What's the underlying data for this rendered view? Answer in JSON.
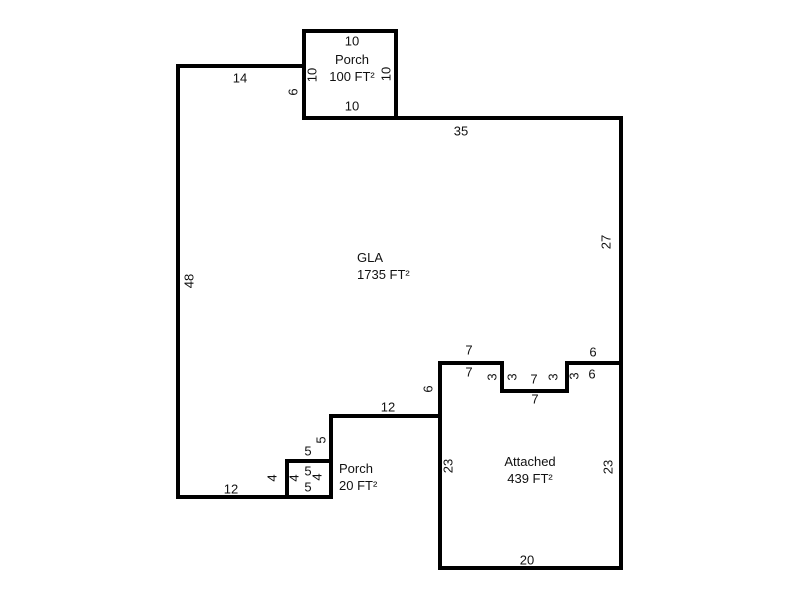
{
  "canvas": {
    "background_color": "#ffffff",
    "wall_color": "#000000",
    "text_color": "#111111"
  },
  "areas": {
    "porch_top": {
      "line1": "Porch",
      "line2": "100 FT²"
    },
    "gla": {
      "line1": "GLA",
      "line2": "1735 FT²"
    },
    "porch_bottom": {
      "line1": "Porch",
      "line2": "20 FT²"
    },
    "attached": {
      "line1": "Attached",
      "line2": "439 FT²"
    }
  },
  "dims": {
    "porch_top_side": "10",
    "porch_left_side": "10",
    "porch_right_side": "10",
    "porch_bottom_side": "10",
    "gla_porch_left_wall": "6",
    "gla_top_left": "14",
    "gla_top_right": "35",
    "gla_right_side": "27",
    "gla_left_side": "48",
    "notch_left_gla": "7",
    "notch_left_att": "7",
    "notch_step1_gla": "3",
    "notch_step1_att": "3",
    "notch_mid_gla": "7",
    "notch_mid_att": "7",
    "notch_step2_gla": "3",
    "notch_step2_att": "3",
    "notch_right_gla": "6",
    "notch_right_att": "6",
    "gla_att_left_wall": "6",
    "gla_step_top": "12",
    "gla_step_right": "5",
    "gla_box_top_outer": "5",
    "box_top_inner": "5",
    "box_bottom_inner": "5",
    "box_left_inner": "4",
    "box_right_inner": "4",
    "box_left_outer": "4",
    "att_left_side": "23",
    "att_right_side": "23",
    "gla_bottom": "12",
    "att_bottom": "20"
  }
}
